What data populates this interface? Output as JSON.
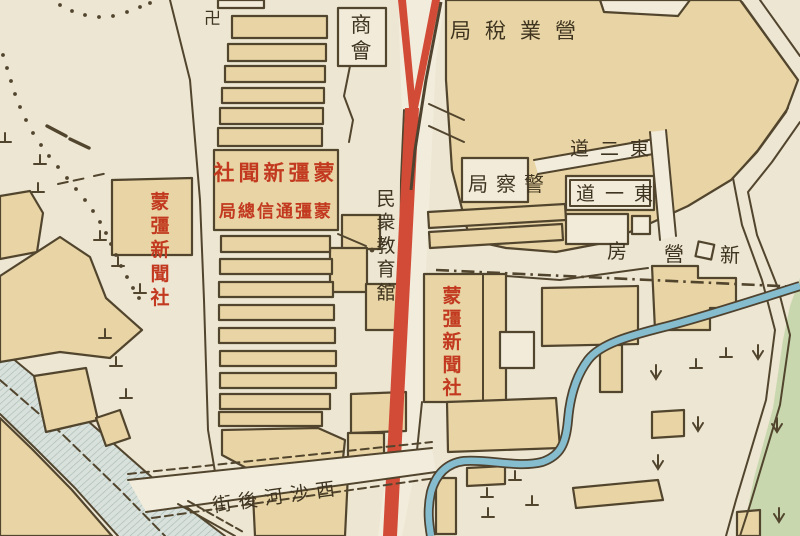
{
  "labels": {
    "chamber_of_commerce": "商會",
    "business_tax_bureau": "局稅業營",
    "mengjiang_news_agency_block_line1": "社聞新彊蒙",
    "mengjiang_comm_general_bureau_line2": "局總信通彊蒙",
    "mengjiang_news_agency_left": "蒙彊新聞社",
    "mengjiang_news_agency_right": "蒙彊新聞社",
    "peoples_education_hall": "民衆教育舘",
    "police_bureau": "局察警",
    "east_second_road": "道二東",
    "east_first_road": "道一東",
    "new_barracks_char1": "房",
    "new_barracks_char2": "營",
    "new_barracks_char3": "新",
    "west_shahe_back_street": "街後河沙西",
    "temple_mark": "卍"
  },
  "colors": {
    "paper": "#EDE6D2",
    "street": "#F2ECDC",
    "block": "#E8D4A4",
    "building": "#F2EBDA",
    "outline": "#52452E",
    "red_road": "#D24B37",
    "red_text": "#C2391F",
    "river_blue": "#85BCCE",
    "green_area": "#C8D7AE",
    "riverbed": "#D8E1DB"
  }
}
